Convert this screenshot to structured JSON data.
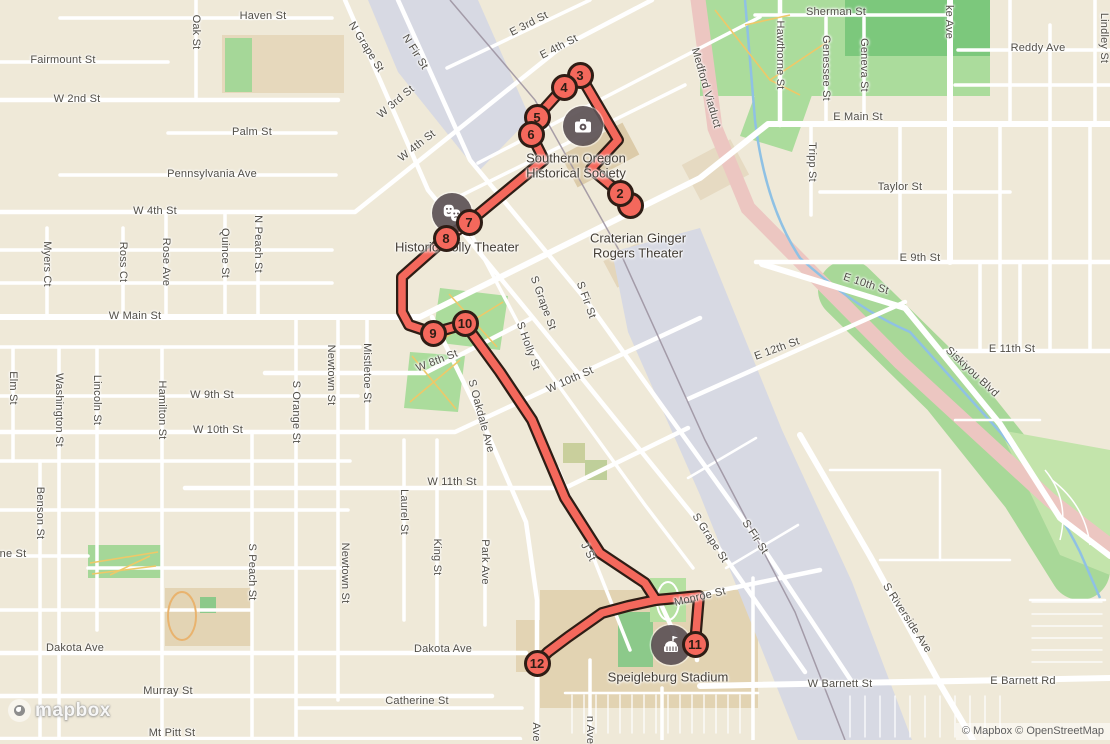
{
  "map": {
    "logo_text": "mapbox",
    "attribution": "© Mapbox © OpenStreetMap",
    "colors": {
      "land": "#EFE9D8",
      "street": "#FFFFFF",
      "park_green": "#ABDC9C",
      "tree_green": "#7CC87C",
      "light_green": "#C3E4AB",
      "tan_grounds": "#E3D4B4",
      "railyard": "#D7D9E3",
      "viaduct_pink": "#ECC6C1",
      "creek_blue": "#8FC1E4",
      "route": "#F4685C",
      "route_casing": "#2E1D15",
      "poi_circle": "#5E5356",
      "label_text": "#514E47"
    },
    "street_labels": [
      {
        "t": "Haven St",
        "x": 263,
        "y": 16,
        "r": 0
      },
      {
        "t": "Sherman St",
        "x": 836,
        "y": 12,
        "r": 0
      },
      {
        "t": "ke Ave",
        "x": 949,
        "y": 22,
        "r": 90
      },
      {
        "t": "Reddy Ave",
        "x": 1038,
        "y": 48,
        "r": 0
      },
      {
        "t": "Lindley St",
        "x": 1104,
        "y": 38,
        "r": 90
      },
      {
        "t": "Fairmount St",
        "x": 63,
        "y": 60,
        "r": 0
      },
      {
        "t": "Oak St",
        "x": 196,
        "y": 32,
        "r": 90
      },
      {
        "t": "Hawthorne St",
        "x": 780,
        "y": 55,
        "r": 90
      },
      {
        "t": "Genessee St",
        "x": 826,
        "y": 68,
        "r": 90
      },
      {
        "t": "Geneva St",
        "x": 864,
        "y": 65,
        "r": 90
      },
      {
        "t": "W 2nd St",
        "x": 77,
        "y": 99,
        "r": 0
      },
      {
        "t": "Palm St",
        "x": 252,
        "y": 132,
        "r": 0
      },
      {
        "t": "E Main St",
        "x": 858,
        "y": 117,
        "r": 0
      },
      {
        "t": "Medford Viaduct",
        "x": 706,
        "y": 88,
        "r": 74
      },
      {
        "t": "N Grape St",
        "x": 366,
        "y": 47,
        "r": 58
      },
      {
        "t": "N Fir St",
        "x": 415,
        "y": 52,
        "r": 58
      },
      {
        "t": "W 3rd St",
        "x": 396,
        "y": 102,
        "r": -40
      },
      {
        "t": "E 3rd St",
        "x": 529,
        "y": 24,
        "r": -27
      },
      {
        "t": "E 4th St",
        "x": 559,
        "y": 47,
        "r": -27
      },
      {
        "t": "W 4th St",
        "x": 417,
        "y": 146,
        "r": -38
      },
      {
        "t": "Pennsylvania Ave",
        "x": 212,
        "y": 174,
        "r": 0
      },
      {
        "t": "W 4th St",
        "x": 155,
        "y": 211,
        "r": 0
      },
      {
        "t": "Tripp St",
        "x": 812,
        "y": 162,
        "r": 90
      },
      {
        "t": "Taylor St",
        "x": 900,
        "y": 187,
        "r": 0
      },
      {
        "t": "Myers Ct",
        "x": 47,
        "y": 264,
        "r": 90
      },
      {
        "t": "Ross Ct",
        "x": 123,
        "y": 262,
        "r": 90
      },
      {
        "t": "Rose Ave",
        "x": 166,
        "y": 262,
        "r": 90
      },
      {
        "t": "Quince St",
        "x": 225,
        "y": 253,
        "r": 90
      },
      {
        "t": "N Peach St",
        "x": 258,
        "y": 244,
        "r": 90
      },
      {
        "t": "E 9th St",
        "x": 920,
        "y": 258,
        "r": 0
      },
      {
        "t": "E 10th St",
        "x": 866,
        "y": 284,
        "r": 18
      },
      {
        "t": "W Main St",
        "x": 135,
        "y": 316,
        "r": 0
      },
      {
        "t": "S Grape St",
        "x": 543,
        "y": 303,
        "r": 70
      },
      {
        "t": "S Fir St",
        "x": 586,
        "y": 300,
        "r": 70
      },
      {
        "t": "S Holly St",
        "x": 528,
        "y": 346,
        "r": 70
      },
      {
        "t": "E 12th St",
        "x": 777,
        "y": 349,
        "r": -20
      },
      {
        "t": "Siskiyou Blvd",
        "x": 972,
        "y": 372,
        "r": 43
      },
      {
        "t": "E 11th St",
        "x": 1012,
        "y": 349,
        "r": 0
      },
      {
        "t": "W 8th St",
        "x": 437,
        "y": 361,
        "r": -21
      },
      {
        "t": "Elm St",
        "x": 13,
        "y": 388,
        "r": 90
      },
      {
        "t": "Washington St",
        "x": 59,
        "y": 410,
        "r": 90
      },
      {
        "t": "Lincoln St",
        "x": 97,
        "y": 400,
        "r": 90
      },
      {
        "t": "Hamilton St",
        "x": 162,
        "y": 410,
        "r": 90
      },
      {
        "t": "Mistletoe St",
        "x": 367,
        "y": 373,
        "r": 90
      },
      {
        "t": "Newtown St",
        "x": 331,
        "y": 375,
        "r": 90
      },
      {
        "t": "S Orange St",
        "x": 296,
        "y": 412,
        "r": 90
      },
      {
        "t": "W 9th St",
        "x": 212,
        "y": 395,
        "r": 0
      },
      {
        "t": "W 10th St",
        "x": 218,
        "y": 430,
        "r": 0
      },
      {
        "t": "W 10th St",
        "x": 570,
        "y": 380,
        "r": -24
      },
      {
        "t": "S Oakdale Ave",
        "x": 481,
        "y": 416,
        "r": 75
      },
      {
        "t": "W 11th St",
        "x": 452,
        "y": 482,
        "r": 0
      },
      {
        "t": "Benson St",
        "x": 40,
        "y": 513,
        "r": 90
      },
      {
        "t": "S Peach St",
        "x": 252,
        "y": 572,
        "r": 90
      },
      {
        "t": "Newtown St",
        "x": 345,
        "y": 573,
        "r": 90
      },
      {
        "t": "Laurel St",
        "x": 404,
        "y": 512,
        "r": 90
      },
      {
        "t": "King St",
        "x": 437,
        "y": 557,
        "r": 90
      },
      {
        "t": "Park Ave",
        "x": 485,
        "y": 562,
        "r": 90
      },
      {
        "t": "J St",
        "x": 588,
        "y": 552,
        "r": 62
      },
      {
        "t": "S Grape St",
        "x": 710,
        "y": 538,
        "r": 57
      },
      {
        "t": "S Fir St",
        "x": 755,
        "y": 537,
        "r": 57
      },
      {
        "t": "Monroe St",
        "x": 700,
        "y": 597,
        "r": -13
      },
      {
        "t": "S Riverside Ave",
        "x": 907,
        "y": 618,
        "r": 57
      },
      {
        "t": "ne St",
        "x": 13,
        "y": 554,
        "r": 0
      },
      {
        "t": "Dakota Ave",
        "x": 75,
        "y": 648,
        "r": 0
      },
      {
        "t": "Dakota Ave",
        "x": 443,
        "y": 649,
        "r": 0
      },
      {
        "t": "Murray St",
        "x": 168,
        "y": 691,
        "r": 0
      },
      {
        "t": "Catherine St",
        "x": 417,
        "y": 701,
        "r": 0
      },
      {
        "t": "Mt Pitt St",
        "x": 172,
        "y": 733,
        "r": 0
      },
      {
        "t": "W Barnett St",
        "x": 840,
        "y": 684,
        "r": 0
      },
      {
        "t": "E Barnett Rd",
        "x": 1023,
        "y": 681,
        "r": 0
      },
      {
        "t": "Ave",
        "x": 536,
        "y": 732,
        "r": 90
      },
      {
        "t": "n Ave",
        "x": 590,
        "y": 730,
        "r": 90
      }
    ],
    "pois": [
      {
        "name": "southern-oregon-historical-society",
        "icon": "camera-icon",
        "x": 583,
        "y": 126,
        "lines": [
          "Southern Oregon",
          "Historical Society"
        ],
        "lx": 576,
        "ly": 166
      },
      {
        "name": "craterian-ginger-rogers-theater",
        "icon": null,
        "x": null,
        "y": null,
        "lines": [
          "Craterian Ginger",
          "Rogers Theater"
        ],
        "lx": 638,
        "ly": 246
      },
      {
        "name": "historic-holly-theater",
        "icon": "theater-icon",
        "x": 452,
        "y": 213,
        "lines": [
          "Historic Holly Theater"
        ],
        "lx": 457,
        "ly": 247
      },
      {
        "name": "speigleburg-stadium",
        "icon": "stadium-icon",
        "x": 671,
        "y": 645,
        "lines": [
          "Speigleburg Stadium"
        ],
        "lx": 668,
        "ly": 677
      }
    ]
  },
  "route": {
    "color": "#F4685C",
    "casing": "#2E1D15",
    "stops": [
      {
        "n": "2",
        "x": 620,
        "y": 193
      },
      {
        "n": "3",
        "x": 580,
        "y": 75
      },
      {
        "n": "4",
        "x": 564,
        "y": 87
      },
      {
        "n": "5",
        "x": 537,
        "y": 117
      },
      {
        "n": "6",
        "x": 531,
        "y": 134
      },
      {
        "n": "7",
        "x": 469,
        "y": 222
      },
      {
        "n": "8",
        "x": 446,
        "y": 238
      },
      {
        "n": "9",
        "x": 433,
        "y": 333
      },
      {
        "n": "10",
        "x": 465,
        "y": 323
      },
      {
        "n": "11",
        "x": 695,
        "y": 644
      },
      {
        "n": "12",
        "x": 537,
        "y": 663
      }
    ],
    "ghost_stop": {
      "x": 630,
      "y": 205
    },
    "paths": [
      [
        [
          629,
          207
        ],
        [
          620,
          193
        ],
        [
          591,
          169
        ],
        [
          618,
          140
        ],
        [
          580,
          75
        ],
        [
          564,
          87
        ],
        [
          537,
          117
        ],
        [
          531,
          134
        ],
        [
          544,
          160
        ],
        [
          469,
          222
        ],
        [
          446,
          238
        ],
        [
          402,
          277
        ],
        [
          402,
          312
        ],
        [
          409,
          325
        ],
        [
          433,
          333
        ],
        [
          465,
          324
        ],
        [
          500,
          372
        ],
        [
          532,
          420
        ],
        [
          565,
          498
        ],
        [
          600,
          553
        ],
        [
          630,
          573
        ],
        [
          645,
          583
        ],
        [
          656,
          600
        ],
        [
          699,
          596
        ],
        [
          695,
          644
        ]
      ],
      [
        [
          656,
          600
        ],
        [
          628,
          606
        ],
        [
          602,
          613
        ],
        [
          568,
          637
        ],
        [
          548,
          652
        ],
        [
          537,
          663
        ]
      ]
    ]
  }
}
